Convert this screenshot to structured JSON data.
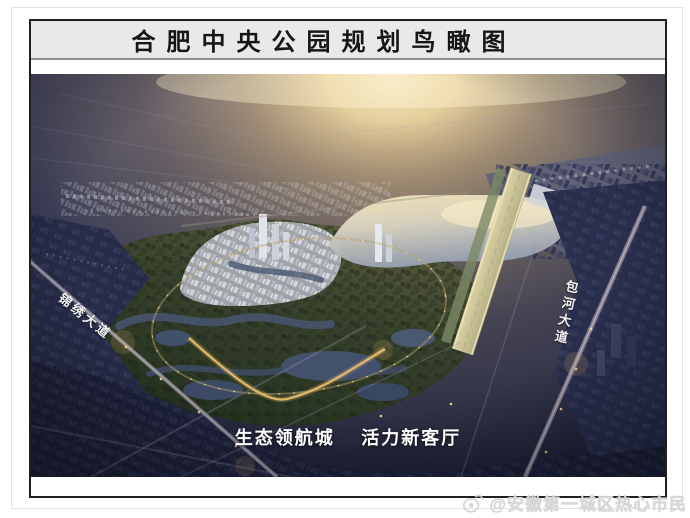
{
  "poster": {
    "title": "合肥中央公园规划鸟瞰图",
    "caption": "生态领航城　 活力新客厅",
    "road_labels": {
      "left": "锦绣大道",
      "right": "包河大道"
    }
  },
  "watermark": {
    "icon": "weibo-logo-icon",
    "text": "@安徽第一城区热心市民"
  },
  "colors": {
    "title_band_bg": "#e9e9e9",
    "frame_border": "#1f1f22",
    "sky_dark": "#23263e",
    "sun_glow": "#fff6d8",
    "park_green": "#39422c",
    "lake_gold": "#f4e6bb",
    "lit_road_gold": "#e8b96a",
    "watermark_gray": "#d7d7d7"
  }
}
